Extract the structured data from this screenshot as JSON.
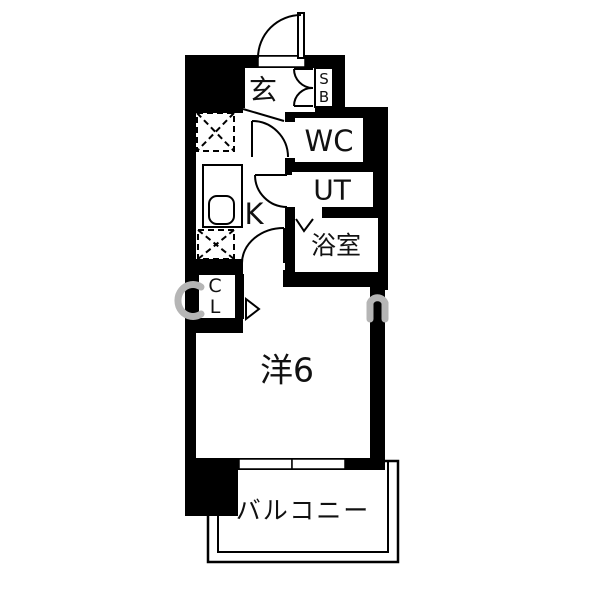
{
  "rooms": {
    "entrance": {
      "label": "玄"
    },
    "shoe_box": {
      "line1": "S",
      "line2": "B"
    },
    "wc": {
      "label": "WC"
    },
    "utility": {
      "label": "UT"
    },
    "bathroom": {
      "label": "浴室"
    },
    "kitchen": {
      "label": "K"
    },
    "closet": {
      "line1": "C",
      "line2": "L"
    },
    "main_room": {
      "label": "洋6"
    },
    "balcony": {
      "label": "バルコニー"
    }
  },
  "colors": {
    "walls": "#000000",
    "lines": "#1a1a1a",
    "background": "#ffffff",
    "watermark": "#b5b5b5"
  }
}
